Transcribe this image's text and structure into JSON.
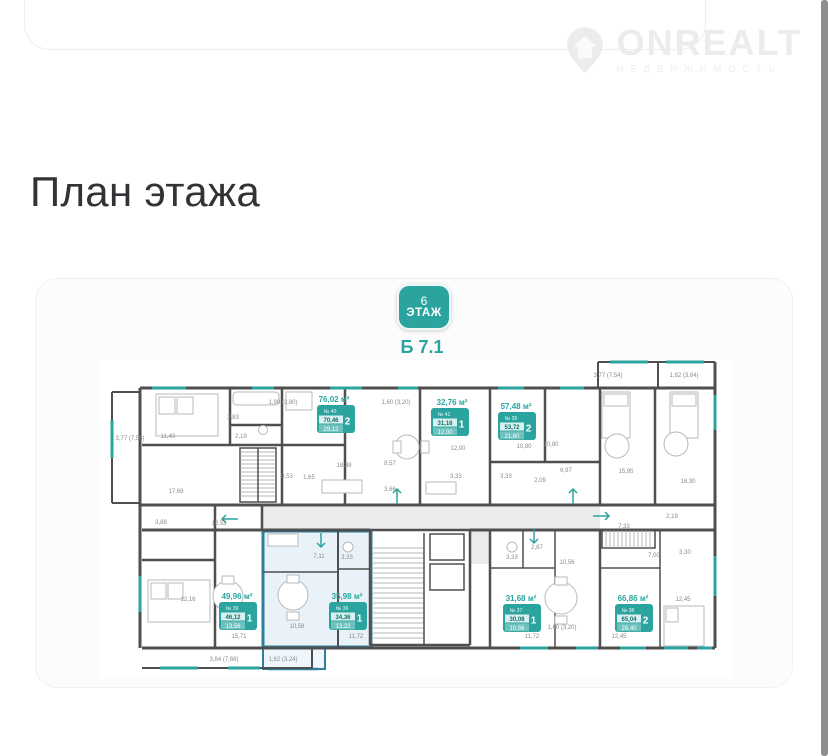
{
  "page": {
    "title": "План этажа"
  },
  "watermark": {
    "brand": "ONREALT",
    "subtitle": "НЕДВИЖИМОСТЬ"
  },
  "plan": {
    "floor_badge": {
      "number": "6",
      "label": "ЭТАЖ"
    },
    "building_label": "Б 7.1",
    "colors": {
      "accent": "#2ba49f",
      "selected": "#2e7f9c",
      "walls": "#4f4f4f"
    },
    "apartments": [
      {
        "number": "№ 40",
        "rooms": "2",
        "total": "76,02 м²",
        "area_live": "70,46",
        "area_extra": "29,12",
        "selected": false
      },
      {
        "number": "№ 41",
        "rooms": "1",
        "total": "32,76 м²",
        "area_live": "31,16",
        "area_extra": "12,00",
        "selected": false
      },
      {
        "number": "№ 35",
        "rooms": "2",
        "total": "57,48 м²",
        "area_live": "53,72",
        "area_extra": "21,60",
        "selected": false
      },
      {
        "number": "№ 39",
        "rooms": "1",
        "total": "49,96 м²",
        "area_live": "46,12",
        "area_extra": "13,56",
        "selected": false
      },
      {
        "number": "№ 36",
        "rooms": "1",
        "total": "35,98 м²",
        "area_live": "34,36",
        "area_extra": "13,22",
        "selected": true
      },
      {
        "number": "№ 37",
        "rooms": "1",
        "total": "31,68 м²",
        "area_live": "30,08",
        "area_extra": "10,56",
        "selected": false
      },
      {
        "number": "№ 38",
        "rooms": "2",
        "total": "66,86 м²",
        "area_live": "65,04",
        "area_extra": "28,40",
        "selected": false
      }
    ],
    "dims": [
      "3,77 (7,56)",
      "11,43",
      "3,83",
      "2,19",
      "1,90 (3,80)",
      "17,69",
      "9,53",
      "1,65",
      "1,60 (3,20)",
      "18,38",
      "8,57",
      "3,66",
      "3,33",
      "12,00",
      "3,33",
      "2,09",
      "10,80",
      "10,80",
      "6,97",
      "15,95",
      "18,30",
      "3,77 (7,54)",
      "1,82 (3,64)",
      "3,88",
      "10,53",
      "12,16",
      "15,71",
      "3,84 (7,68)",
      "7,11",
      "3,33",
      "10,58",
      "11,72",
      "1,62 (3,24)",
      "2,87",
      "3,33",
      "10,56",
      "11,72",
      "1,60 (3,20)",
      "7,33",
      "2,19",
      "7,00",
      "3,30",
      "12,45",
      "12,45"
    ]
  }
}
